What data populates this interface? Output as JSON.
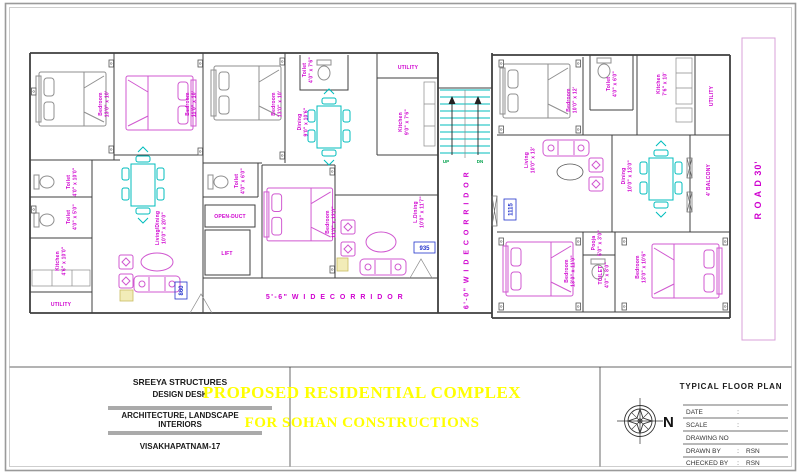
{
  "sheet": {
    "colors": {
      "label_magenta": "#cf00cf",
      "furniture_cyan": "#00bdbd",
      "stair_green": "#00a14b",
      "tag_blue": "#2233cc",
      "title_yellow": "#ffff00"
    }
  },
  "plan": {
    "corridor_bottom": "5'-6\"  W I D E   C O R R I D O R",
    "corridor_central": "6'-0\" W I D E  C O R R I D O R",
    "road": "R O A D   30'",
    "stairs": {
      "up": "UP",
      "dn": "DN"
    },
    "tags": {
      "flat_left": "860",
      "flat_mid": "935",
      "flat_right": "1115"
    },
    "rooms": {
      "bed1": {
        "name": "Bedroom",
        "size": "13'0\" x 10'"
      },
      "bed2": {
        "name": "Bedroom",
        "size": "11'0\" x 10'"
      },
      "bed3": {
        "name": "Bedroom",
        "size": "13'0\" x 10'"
      },
      "toilet_top": {
        "name": "Toilet",
        "size": "4'0\" x 7'6\""
      },
      "utility_top": {
        "name": "UTILITY"
      },
      "dining_left": {
        "name": "Dining",
        "size": "9'0\" x 10'6\""
      },
      "kitchen_top": {
        "name": "Kitchen",
        "size": "9'0\" x 7'6\""
      },
      "toilet_mid1": {
        "name": "Toilet",
        "size": "4'0\" x 10'0\""
      },
      "toilet_mid2": {
        "name": "Toilet",
        "size": "4'0\" x 5'0\""
      },
      "kitchen_left": {
        "name": "Kitchen",
        "size": "4'6\" x 10'0\""
      },
      "utility_left": {
        "name": "UTILITY"
      },
      "living_dining": {
        "name": "Living/Dining",
        "size": "10'0\" x 20'0\""
      },
      "toilet_center": {
        "name": "Toilet",
        "size": "4'0\" x 6'0\""
      },
      "open_duct": {
        "name": "OPEN-DUCT"
      },
      "lift": {
        "name": "LIFT"
      },
      "bed_center": {
        "name": "Bedroom",
        "size": "11'0\" x 12'0\""
      },
      "l_dining": {
        "name": "L.Dining",
        "size": "10'0\" x 11'7\""
      },
      "bed_r1": {
        "name": "Bedroom",
        "size": "10'0\" x 12'"
      },
      "toilet_r1": {
        "name": "Toilet",
        "size": "4'0\" x 6'0\""
      },
      "kitchen_r": {
        "name": "Kitchen",
        "size": "7'6\" x 10'"
      },
      "utility_r": {
        "name": "UTILITY"
      },
      "living_r": {
        "name": "Living",
        "size": "10'0\" x 13'"
      },
      "dining_r": {
        "name": "Dining",
        "size": "10'0\" x 13'0\""
      },
      "balcony": {
        "name": "4' BALCONY"
      },
      "pooja": {
        "name": "Pooja",
        "size": "5'0\" x 3'0\""
      },
      "toilet_rb": {
        "name": "TOILET",
        "size": "4'0\" x 8'0\""
      },
      "bed_rb1": {
        "name": "Bedroom",
        "size": "13'0\" x 11'0\""
      },
      "bed_rb2": {
        "name": "Bedroom",
        "size": "13'0\" x 10'6\""
      }
    }
  },
  "title_block": {
    "company": {
      "line1": "SREEYA STRUCTURES",
      "line2": "DESIGN DESK",
      "line3": "ARCHITECTURE, LANDSCAPE",
      "line4": "INTERIORS",
      "line5": "VISAKHAPATNAM-17"
    },
    "project": {
      "line1": "PROPOSED RESIDENTIAL COMPLEX",
      "line2": "FOR  SOHAN CONSTRUCTIONS"
    },
    "drawing": {
      "title": "TYPICAL FLOOR PLAN",
      "north": "N",
      "rows": [
        {
          "label": "DATE",
          "colon": ":",
          "value": ""
        },
        {
          "label": "SCALE",
          "colon": ":",
          "value": ""
        },
        {
          "label": "DRAWING  NO",
          "colon": "",
          "value": ""
        },
        {
          "label": "DRAWN  BY",
          "colon": ":",
          "value": "RSN"
        },
        {
          "label": "CHECKED  BY",
          "colon": ":",
          "value": "RSN"
        }
      ]
    }
  }
}
